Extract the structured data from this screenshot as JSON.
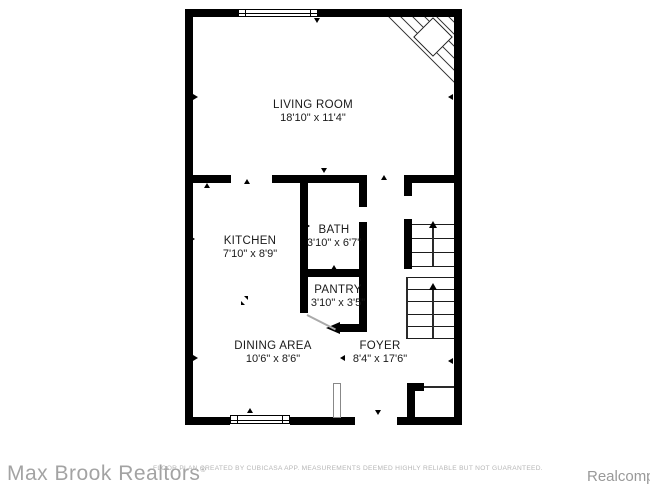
{
  "branding": {
    "agency": "Max Brook Realtors",
    "agency_mark": "®",
    "disclaimer": "FLOOR PLAN CREATED BY CUBICASA APP. MEASUREMENTS DEEMED HIGHLY RELIABLE BUT NOT GUARANTEED.",
    "provider": "Realcomp"
  },
  "floorplan": {
    "rooms": [
      {
        "name": "LIVING ROOM",
        "dimensions": "18'10\" x 11'4\""
      },
      {
        "name": "KITCHEN",
        "dimensions": "7'10\" x 8'9\""
      },
      {
        "name": "BATH",
        "dimensions": "3'10\" x 6'7\""
      },
      {
        "name": "PANTRY",
        "dimensions": "3'10\" x 3'5\""
      },
      {
        "name": "DINING AREA",
        "dimensions": "10'6\" x 8'6\""
      },
      {
        "name": "FOYER",
        "dimensions": "8'4\" x 17'6\""
      }
    ],
    "symbols": [
      "corner-fireplace",
      "staircase-up",
      "windows",
      "front-door",
      "foyer-closet"
    ],
    "colors": {
      "wall": "#000000",
      "background": "#ffffff",
      "room_label": "#1a1a1a",
      "agency_text": "#a3a3a3",
      "disclaimer_text": "#b6b6b6",
      "provider_text": "#999999"
    }
  }
}
